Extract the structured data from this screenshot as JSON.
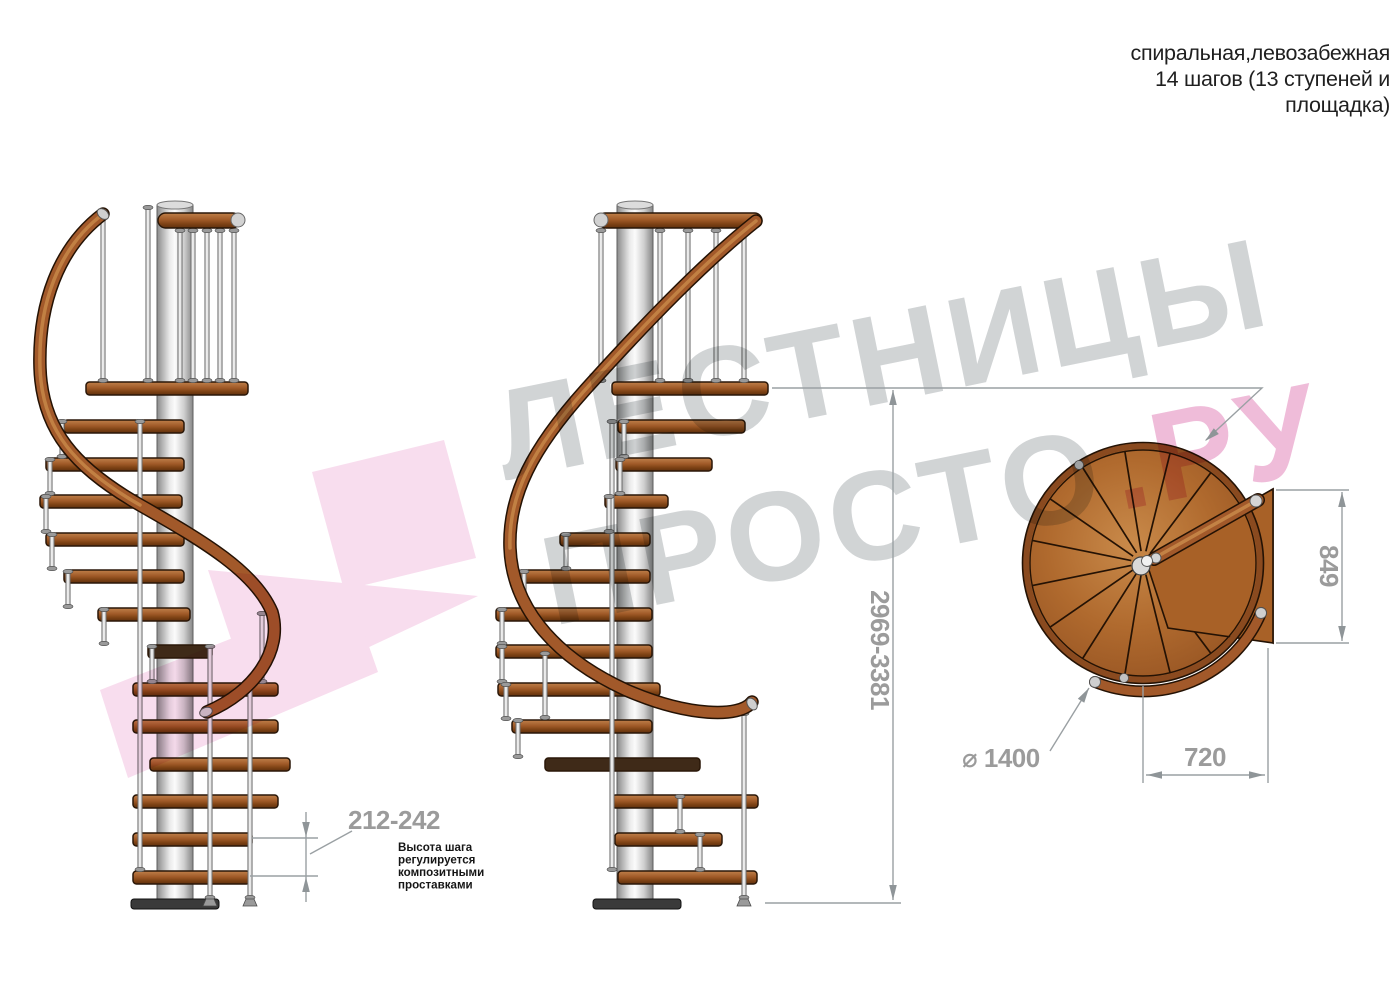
{
  "title": {
    "lines": [
      "спиральная,левозабежная",
      "14 шагов (13 ступеней и",
      "площадка)"
    ]
  },
  "watermark": {
    "word1": "ЛЕСТНИЦЫ",
    "word2": "ПРОСТО",
    "suffix": ".РУ"
  },
  "dimensions": {
    "total_height": "2969-3381",
    "step_height_range": "212-242",
    "platform_depth": "849",
    "platform_width": "720",
    "diameter": "⌀ 1400"
  },
  "note": {
    "lines": [
      "Высота шага",
      "регулируется",
      "композитными",
      "проставками"
    ]
  },
  "colors": {
    "wood_light": "#c98a4a",
    "wood_mid": "#a2592a",
    "wood_dark": "#5f300e",
    "drawing_outline": "#2a1708",
    "metal_light": "#f4f4f4",
    "metal_dark": "#8a8a8a",
    "dimension_line": "#9aa0a3",
    "dimension_text": "#9b9b9b",
    "title_text": "#1f1f1f",
    "watermark_gray": "#cbced0",
    "watermark_pink": "#edb3d4",
    "watermark_pink_shape": "#f7d7eb"
  }
}
